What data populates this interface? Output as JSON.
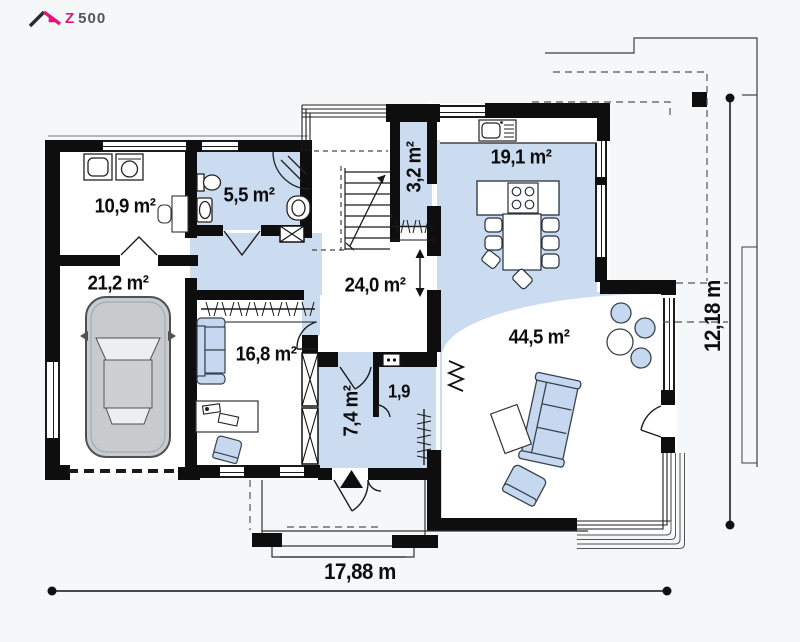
{
  "logo": {
    "z": "Z",
    "rest": "500"
  },
  "rooms": [
    {
      "name": "utility",
      "label": "10,9 m²"
    },
    {
      "name": "bathroom",
      "label": "5,5 m²"
    },
    {
      "name": "garage",
      "label": "21,2 m²"
    },
    {
      "name": "office",
      "label": "16,8 m²"
    },
    {
      "name": "hall",
      "label": "24,0 m²"
    },
    {
      "name": "pantry",
      "label": "3,2 m²"
    },
    {
      "name": "kitchen",
      "label": "19,1 m²"
    },
    {
      "name": "living-room",
      "label": "44,5 m²"
    },
    {
      "name": "vestibule",
      "label": "7,4 m²"
    },
    {
      "name": "closet",
      "label": "1,9"
    }
  ],
  "dimensions": {
    "width": "17,88 m",
    "depth": "12,18 m"
  },
  "colors": {
    "room_highlight": "#cbdcf1",
    "wall": "#0e0e0f",
    "logo_accent": "#e5137d",
    "furniture_fill": "#c5d8ef"
  }
}
